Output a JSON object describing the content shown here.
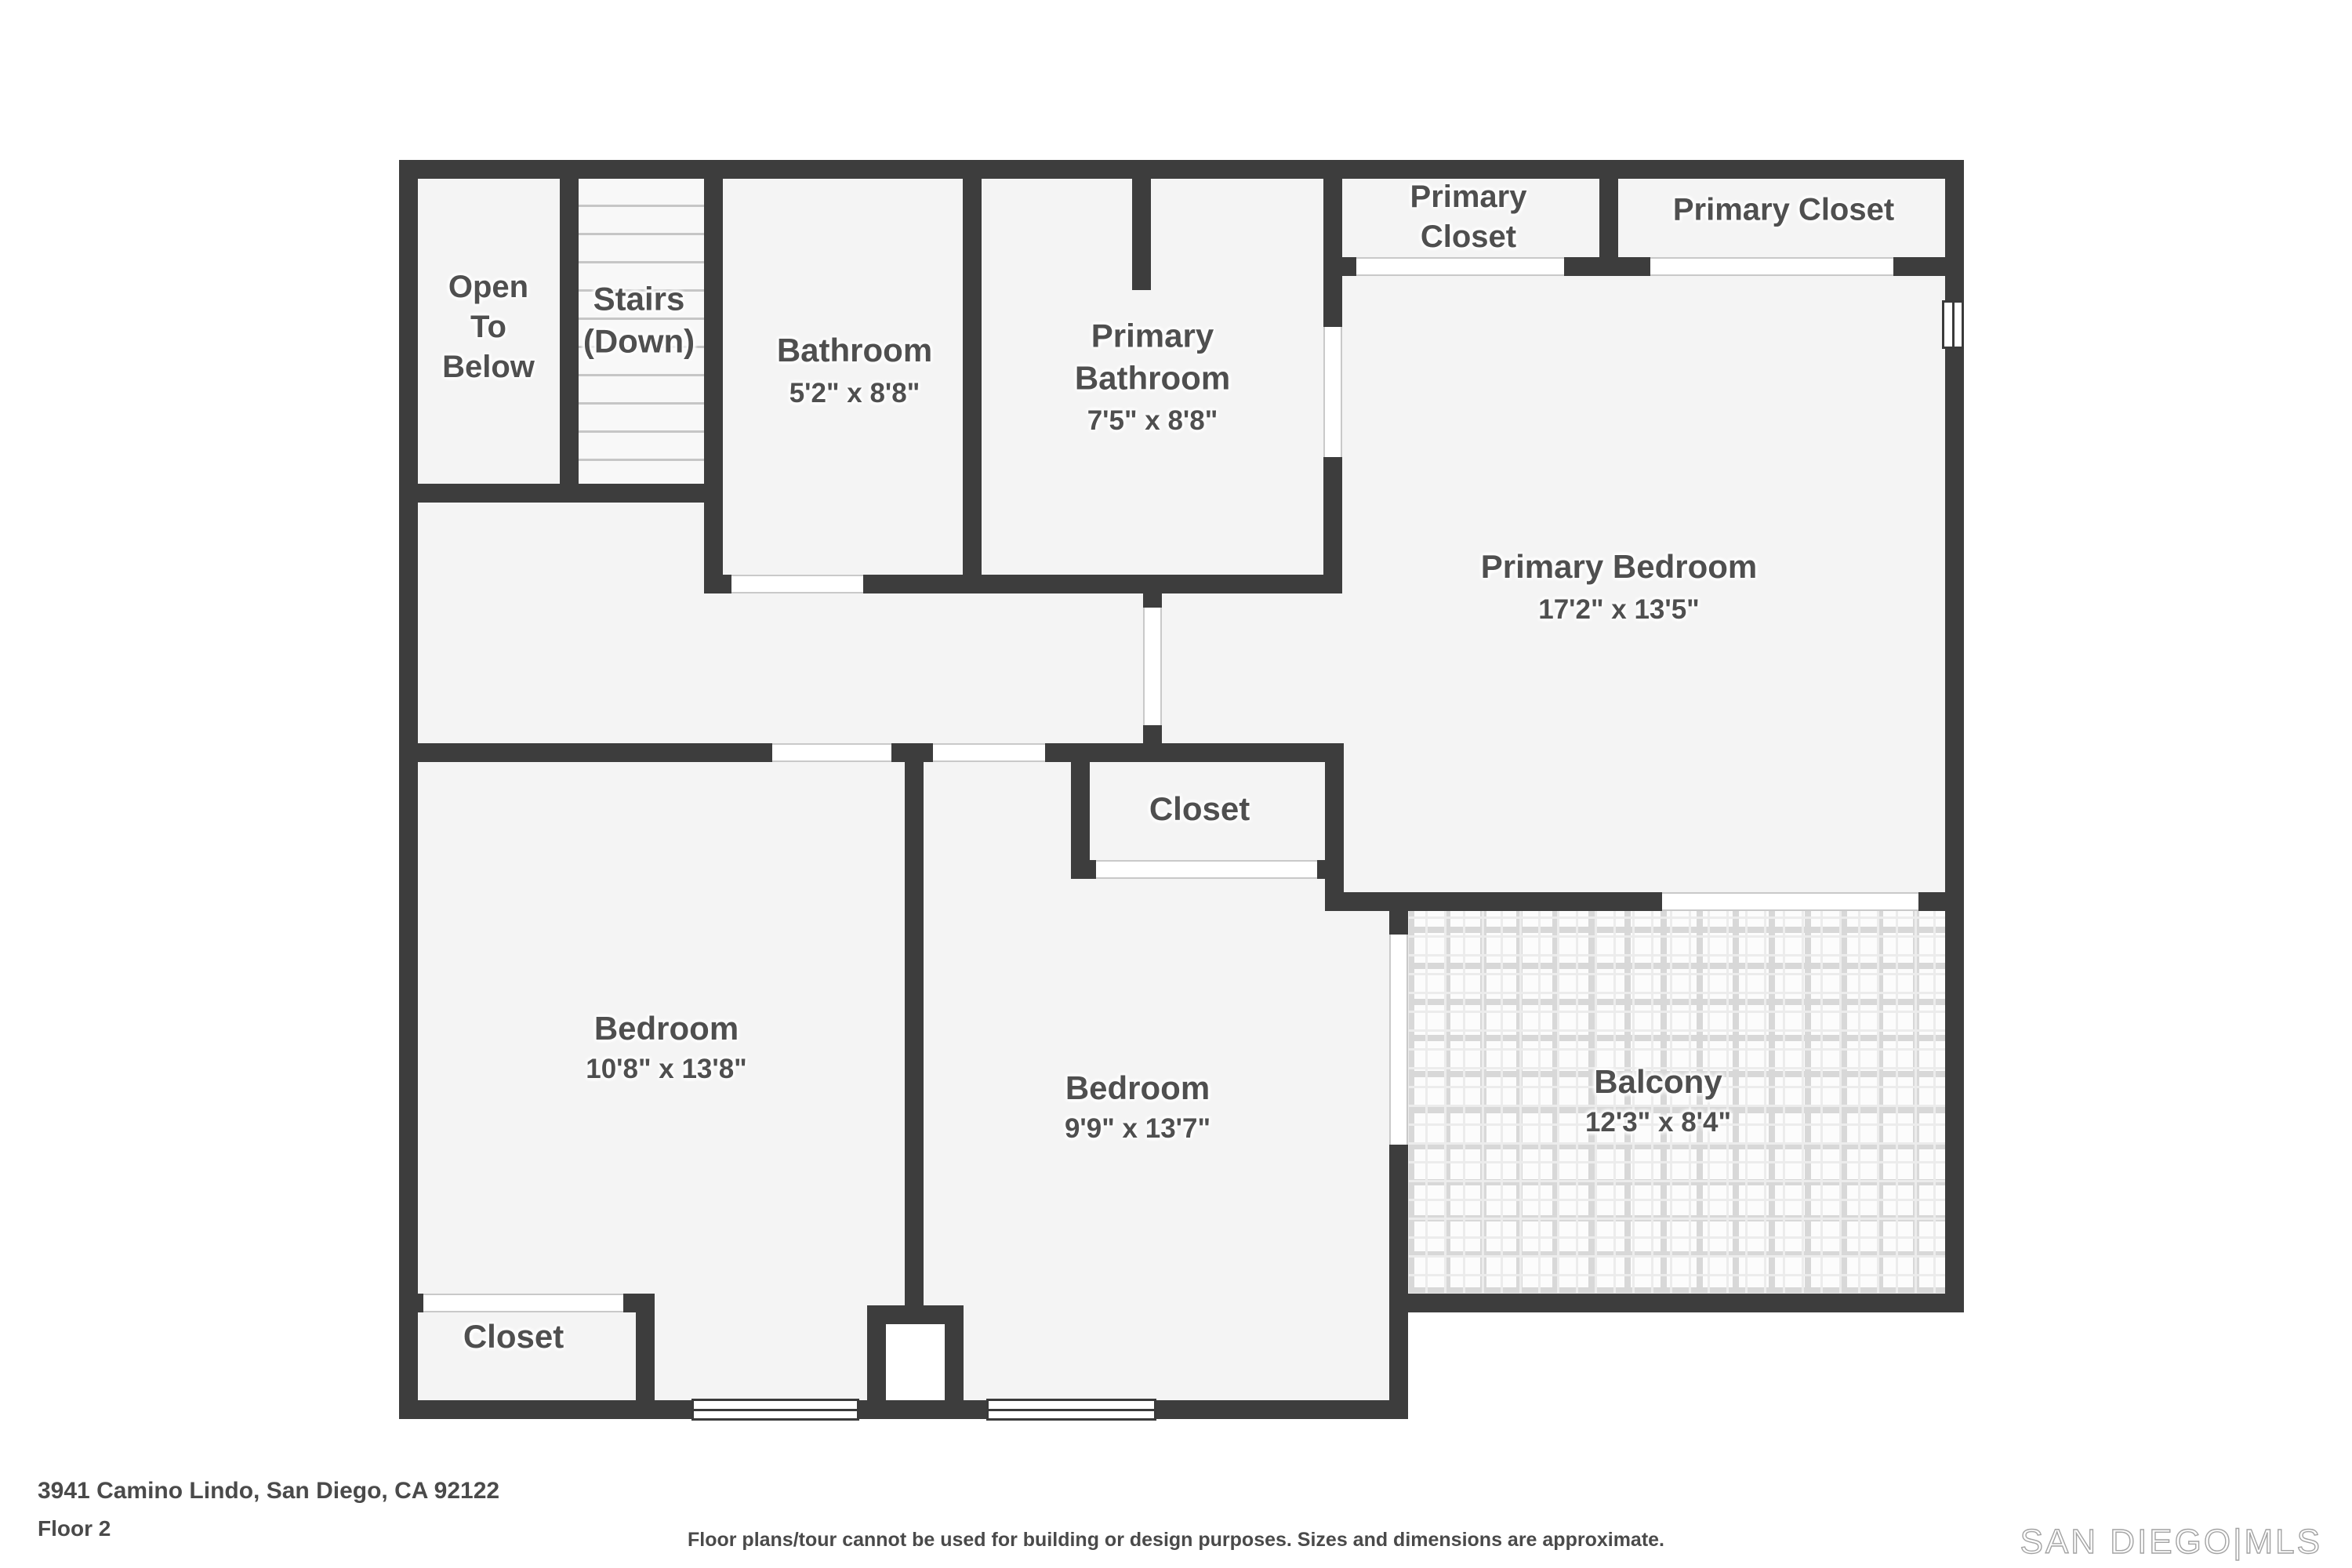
{
  "colors": {
    "wall": "#3d3d3d",
    "floor": "#f4f4f4",
    "floor_light": "#f8f8f8",
    "tile_line": "#d8d8d8",
    "label": "#4f4f4f",
    "door_line": "#c9c9c9"
  },
  "rooms": {
    "open_to_below": {
      "name": "Open\nTo\nBelow"
    },
    "stairs": {
      "name": "Stairs\n(Down)"
    },
    "bathroom": {
      "name": "Bathroom",
      "dims": "5'2\" x 8'8\""
    },
    "primary_bathroom": {
      "name": "Primary\nBathroom",
      "dims": "7'5\" x 8'8\""
    },
    "primary_closet_left": {
      "name": "Primary\nCloset"
    },
    "primary_closet_right": {
      "name": "Primary Closet"
    },
    "primary_bedroom": {
      "name": "Primary Bedroom",
      "dims": "17'2\" x 13'5\""
    },
    "closet_middle": {
      "name": "Closet"
    },
    "bedroom_left": {
      "name": "Bedroom",
      "dims": "10'8\" x 13'8\""
    },
    "bedroom_middle": {
      "name": "Bedroom",
      "dims": "9'9\" x 13'7\""
    },
    "balcony": {
      "name": "Balcony",
      "dims": "12'3\" x 8'4\""
    },
    "closet_bottom": {
      "name": "Closet"
    }
  },
  "footer": {
    "address": "3941 Camino Lindo, San Diego, CA 92122",
    "floor_label": "Floor 2",
    "disclaimer": "Floor plans/tour cannot be used for building or design purposes. Sizes and dimensions are approximate.",
    "logo": "SAN DIEGO|MLS"
  }
}
